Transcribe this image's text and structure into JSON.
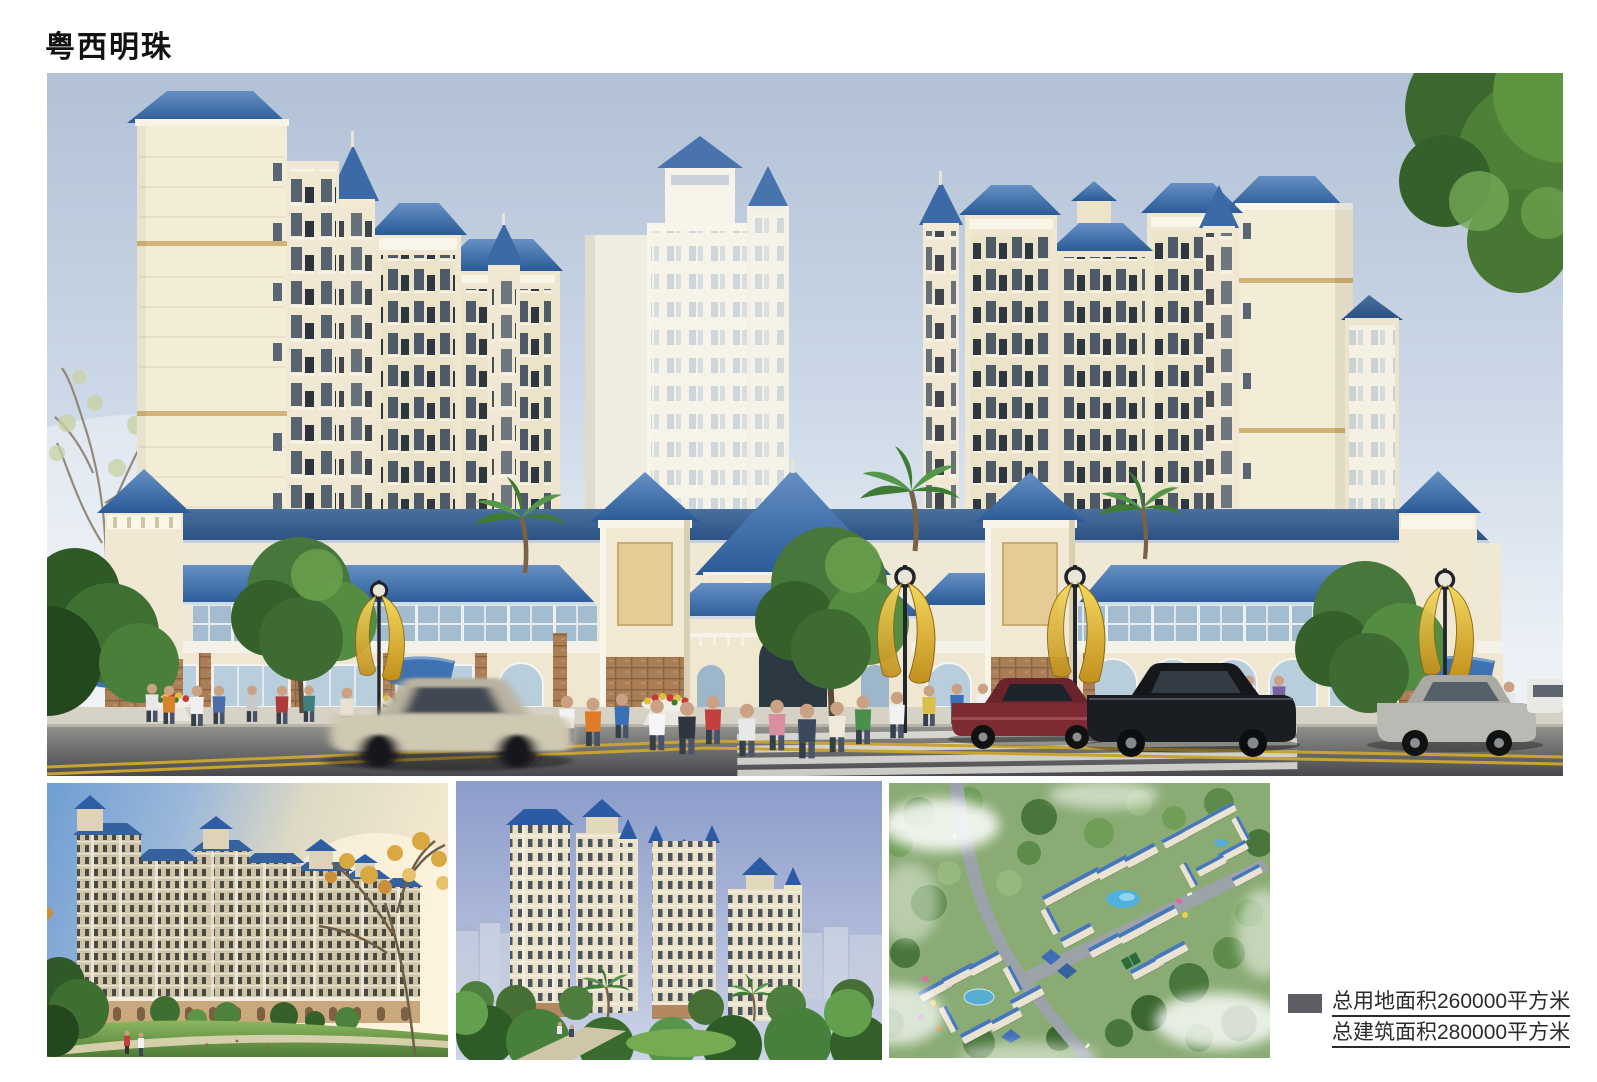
{
  "header": {
    "title": "粤西明珠"
  },
  "legend": {
    "lines": [
      "总用地面积260000平方米",
      "总建筑面积280000平方米"
    ],
    "bullet_color": "#5c5e63"
  },
  "palette": {
    "roof_blue": "#2e5f9e",
    "wall_cream": "#f3ecd8",
    "banner_gold": "#e3b93c",
    "sky_top": "#b2c1d6",
    "text_dark": "#2b2b2b"
  }
}
